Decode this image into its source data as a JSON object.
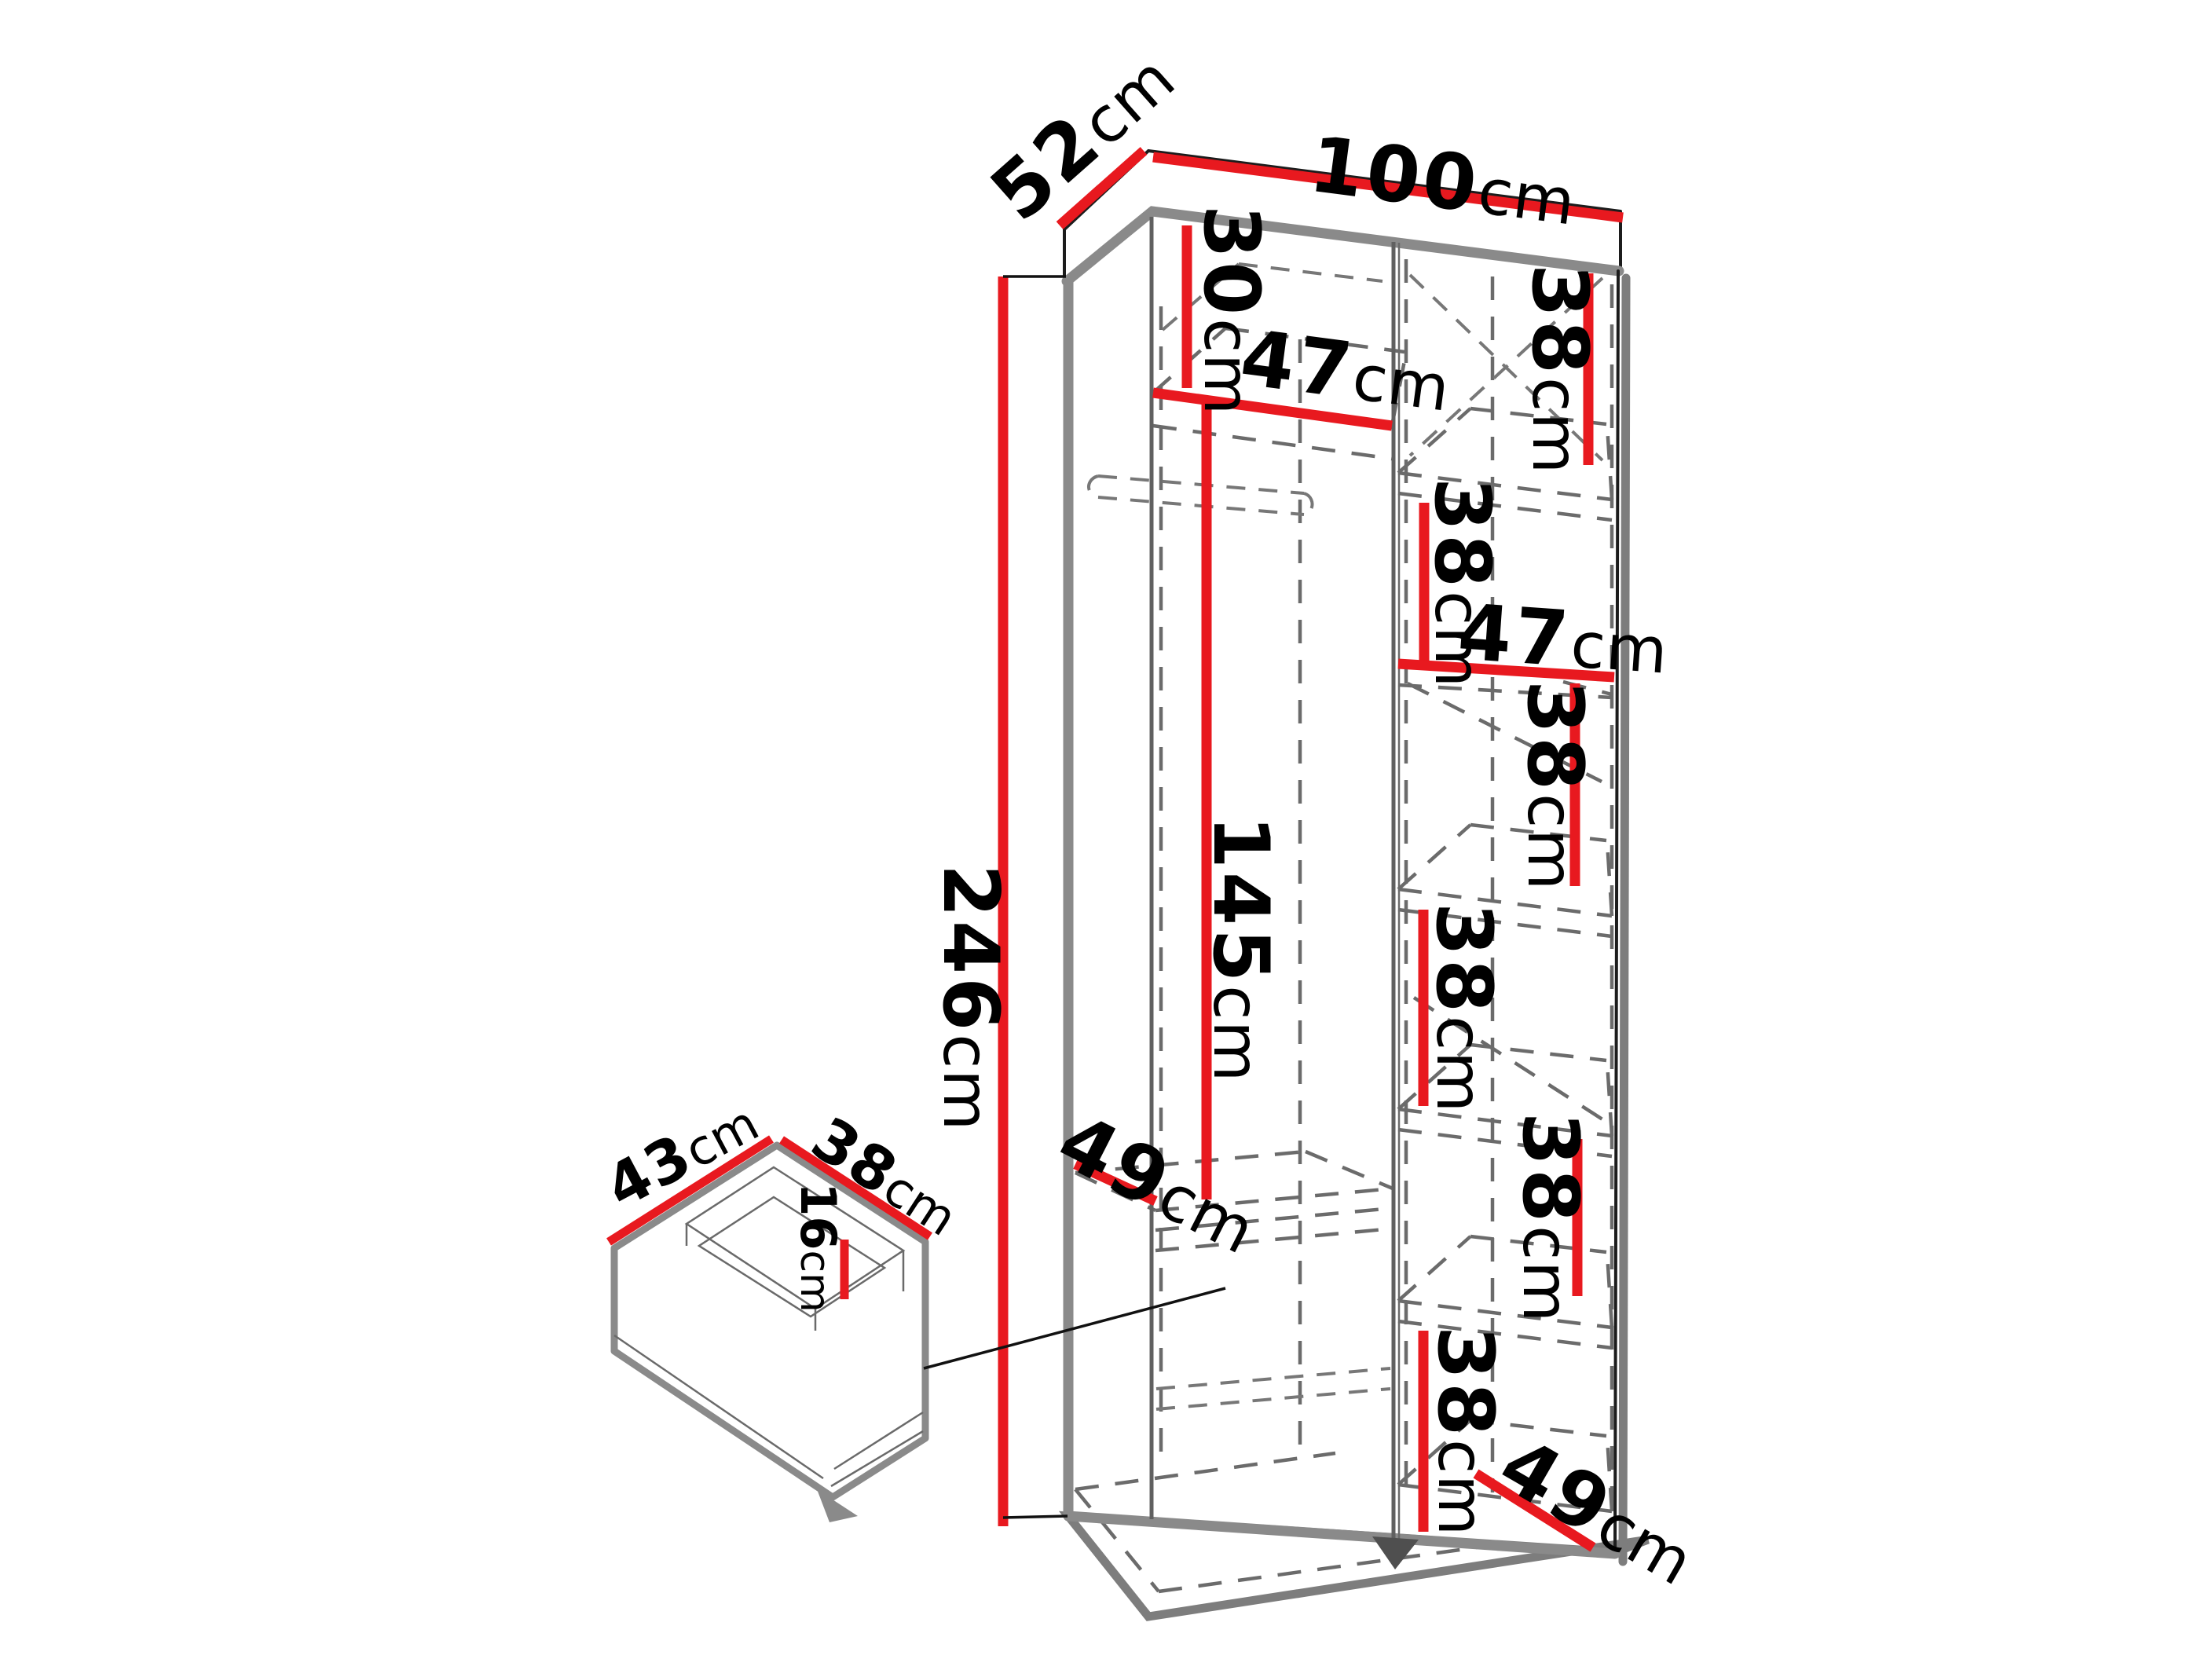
{
  "diagram": {
    "unit": "cm",
    "colors": {
      "dimension_red": "#e8191f",
      "carcass_gray": "#8a8a8a",
      "dashed_gray": "#6b6b6b",
      "line_black": "#1c1c1c",
      "background": "#ffffff"
    },
    "wardrobe": {
      "width": {
        "num": "100",
        "unit": "cm"
      },
      "depth": {
        "num": "52",
        "unit": "cm"
      },
      "height": {
        "num": "246",
        "unit": "cm"
      },
      "left_column": {
        "top_compartment_height": {
          "num": "30",
          "unit": "cm"
        },
        "shelf_width": {
          "num": "47",
          "unit": "cm"
        },
        "hanging_space_height": {
          "num": "145",
          "unit": "cm"
        },
        "bottom_shelf_depth": {
          "num": "49",
          "unit": "cm"
        }
      },
      "right_column": {
        "shelf_width": {
          "num": "47",
          "unit": "cm"
        },
        "bottom_shelf_depth": {
          "num": "49",
          "unit": "cm"
        },
        "compartment_heights": [
          {
            "num": "38",
            "unit": "cm"
          },
          {
            "num": "38",
            "unit": "cm"
          },
          {
            "num": "38",
            "unit": "cm"
          },
          {
            "num": "38",
            "unit": "cm"
          },
          {
            "num": "38",
            "unit": "cm"
          },
          {
            "num": "38",
            "unit": "cm"
          }
        ]
      }
    },
    "drawer": {
      "inner_width": {
        "num": "43",
        "unit": "cm"
      },
      "inner_depth": {
        "num": "38",
        "unit": "cm"
      },
      "inner_height": {
        "num": "16",
        "unit": "cm"
      }
    }
  }
}
